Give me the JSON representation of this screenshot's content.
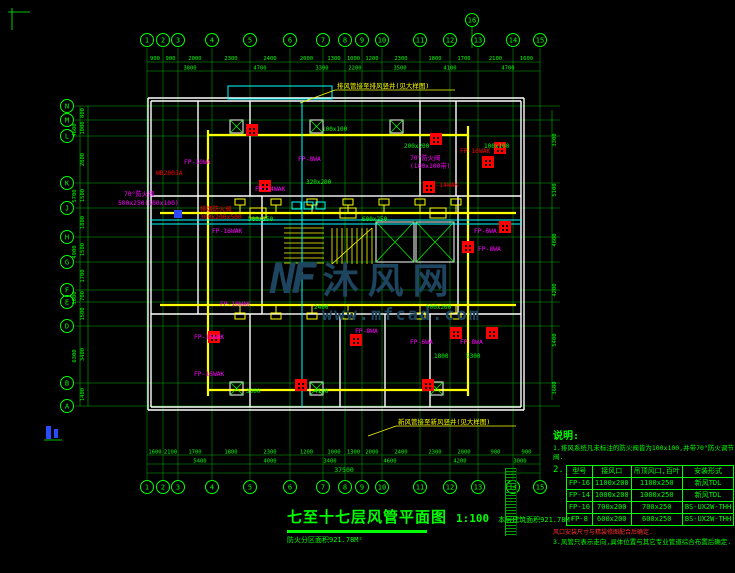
{
  "watermark": {
    "logo": "NF",
    "brand": "沐风网",
    "url": "www.mfcad.com",
    "color": "#1d4560"
  },
  "title_block": {
    "title": "七至十七层风管平面图",
    "scale": "1:100",
    "area_note": "本层建筑面积921.78M²",
    "fire_note": "防火分区面积921.78M²"
  },
  "notes": {
    "heading": "说明:",
    "note1": "1.排风系统凡未标注的防火阀皆为100x100,并带70°防火调节阀.",
    "note2_index": "2.",
    "table_footnote": "风口安装尺寸与精装修图配合后确定.",
    "note3": "3.风管只表示走向,具体位置与其它专业管道综合布置后确定."
  },
  "fan_coil_table": {
    "headers": [
      "型号",
      "接风口",
      "吊顶风口,百叶",
      "安装形式"
    ],
    "rows": [
      [
        "FP-16",
        "1100x200",
        "1100x250",
        "新风TDL"
      ],
      [
        "FP-14",
        "1000x200",
        "1000x250",
        "新风TDL"
      ],
      [
        "FP-10",
        "700x200",
        "700x250",
        "BS-UX2W-THH"
      ],
      [
        "FP-8",
        "600x200",
        "600x250",
        "BS-UX2W-THH"
      ]
    ]
  },
  "plan": {
    "axis_bubbles": {
      "top": [
        {
          "x": 147,
          "label": "1"
        },
        {
          "x": 163,
          "label": "2"
        },
        {
          "x": 178,
          "label": "3"
        },
        {
          "x": 212,
          "label": "4"
        },
        {
          "x": 250,
          "label": "5"
        },
        {
          "x": 290,
          "label": "6"
        },
        {
          "x": 323,
          "label": "7"
        },
        {
          "x": 345,
          "label": "8"
        },
        {
          "x": 362,
          "label": "9"
        },
        {
          "x": 382,
          "label": "10"
        },
        {
          "x": 420,
          "label": "11"
        },
        {
          "x": 450,
          "label": "12"
        },
        {
          "x": 478,
          "label": "13"
        },
        {
          "x": 513,
          "label": "14"
        },
        {
          "x": 540,
          "label": "15"
        }
      ],
      "left": [
        {
          "y": 106,
          "label": "N"
        },
        {
          "y": 120,
          "label": "M"
        },
        {
          "y": 136,
          "label": "L"
        },
        {
          "y": 183,
          "label": "K"
        },
        {
          "y": 208,
          "label": "J"
        },
        {
          "y": 237,
          "label": "H"
        },
        {
          "y": 262,
          "label": "G"
        },
        {
          "y": 290,
          "label": "F"
        },
        {
          "y": 302,
          "label": "E"
        },
        {
          "y": 326,
          "label": "D"
        },
        {
          "y": 383,
          "label": "B"
        },
        {
          "y": 406,
          "label": "A"
        }
      ],
      "extra": [
        {
          "x": 472,
          "y": 20,
          "label": "16"
        }
      ]
    },
    "dims": {
      "top1": [
        "900",
        "900",
        "2000",
        "2300",
        "2400",
        "2000",
        "1300",
        "1000",
        "1200",
        "2300",
        "1800",
        "1700",
        "2100",
        "1600"
      ],
      "top2": [
        {
          "v": "3800",
          "x": 190
        },
        {
          "v": "4700",
          "x": 260
        },
        {
          "v": "3300",
          "x": 322
        },
        {
          "v": "2200",
          "x": 355
        },
        {
          "v": "3500",
          "x": 400
        },
        {
          "v": "4100",
          "x": 450
        },
        {
          "v": "4700",
          "x": 508
        }
      ],
      "bottom1": [
        "1600",
        "2100",
        "1700",
        "1800",
        "2300",
        "1200",
        "1000",
        "1300",
        "2000",
        "2400",
        "2300",
        "2000",
        "900",
        "900"
      ],
      "bottom2": [
        {
          "v": "5400",
          "x": 200
        },
        {
          "v": "4000",
          "x": 270
        },
        {
          "v": "3400",
          "x": 330
        },
        {
          "v": "4600",
          "x": 390
        },
        {
          "v": "4200",
          "x": 460
        },
        {
          "v": "3000",
          "x": 520
        }
      ],
      "bottom_total": "37500",
      "left1": [
        "800",
        "1000",
        "2800",
        "1500",
        "1800",
        "1500",
        "1700",
        "700",
        "1500",
        "3400",
        "1400"
      ],
      "left2": [
        {
          "v": "4600",
          "y": 130
        },
        {
          "v": "5700",
          "y": 196
        },
        {
          "v": "4900",
          "y": 252
        },
        {
          "v": "3800",
          "y": 298
        },
        {
          "v": "6300",
          "y": 356
        }
      ],
      "right": [
        {
          "v": "3300",
          "y": 140
        },
        {
          "v": "5100",
          "y": 190
        },
        {
          "v": "4800",
          "y": 240
        },
        {
          "v": "4200",
          "y": 290
        },
        {
          "v": "5400",
          "y": 340
        },
        {
          "v": "3600",
          "y": 388
        }
      ]
    },
    "texts": [
      [
        "FP-10WA",
        184,
        164,
        "m"
      ],
      [
        "FP-8WA",
        298,
        161,
        "m"
      ],
      [
        "70°防火阀",
        124,
        196,
        "m"
      ],
      [
        "500x250(100x100)",
        118,
        205,
        "m"
      ],
      [
        "70°防火阀",
        410,
        160,
        "m"
      ],
      [
        "(100x100带)",
        410,
        168,
        "m"
      ],
      [
        "FP-16WAK",
        212,
        233,
        "m"
      ],
      [
        "FP-10WAK",
        220,
        306,
        "m"
      ],
      [
        "FP-16WAK",
        194,
        339,
        "m"
      ],
      [
        "FP-16WAK",
        194,
        376,
        "m"
      ],
      [
        "FP-8WA",
        355,
        333,
        "m"
      ],
      [
        "FP-6WA",
        410,
        344,
        "m"
      ],
      [
        "FP-8WA",
        460,
        344,
        "m"
      ],
      [
        "FP-6WA",
        474,
        233,
        "m"
      ],
      [
        "FP-8WA",
        478,
        251,
        "m"
      ],
      [
        "FP-14WAK",
        255,
        191,
        "m"
      ],
      [
        "WB200JA",
        156,
        175,
        "r"
      ],
      [
        "排烟防火阀",
        200,
        211,
        "r"
      ],
      [
        "300x200x500",
        200,
        219,
        "r"
      ],
      [
        "FP-16WAK",
        460,
        153,
        "r"
      ],
      [
        "FP-14WAK",
        428,
        187,
        "r"
      ],
      [
        "200x200",
        404,
        148,
        "g"
      ],
      [
        "100x100",
        484,
        148,
        "g"
      ],
      [
        "320x200",
        306,
        184,
        "g"
      ],
      [
        "500x250",
        248,
        221,
        "g"
      ],
      [
        "600x250",
        362,
        221,
        "g"
      ],
      [
        "500x200",
        426,
        309,
        "g"
      ],
      [
        "4100",
        314,
        393,
        "g"
      ],
      [
        "1800",
        434,
        358,
        "g"
      ],
      [
        "5300",
        466,
        358,
        "g"
      ],
      [
        "2400",
        314,
        309,
        "g"
      ],
      [
        "3300",
        246,
        393,
        "g"
      ],
      [
        "100x100",
        322,
        131,
        "g"
      ]
    ],
    "leader_notes": [
      {
        "t": "排风管接至排风竖井(见大样图)",
        "x": 337,
        "y": 88,
        "lx2": 300,
        "ly2": 103
      },
      {
        "t": "新风管接至新风竖井(见大样图)",
        "x": 398,
        "y": 424,
        "lx2": 368,
        "ly2": 436
      }
    ],
    "equipment_squares": [
      [
        246,
        124
      ],
      [
        430,
        133
      ],
      [
        494,
        142
      ],
      [
        482,
        156
      ],
      [
        259,
        180
      ],
      [
        423,
        181
      ],
      [
        499,
        221
      ],
      [
        462,
        241
      ],
      [
        208,
        331
      ],
      [
        350,
        334
      ],
      [
        450,
        327
      ],
      [
        486,
        327
      ],
      [
        295,
        379
      ],
      [
        422,
        379
      ]
    ],
    "shaft_boxes": [
      [
        230,
        120
      ],
      [
        310,
        120
      ],
      [
        390,
        120
      ],
      [
        230,
        382
      ],
      [
        310,
        382
      ],
      [
        430,
        382
      ]
    ]
  }
}
